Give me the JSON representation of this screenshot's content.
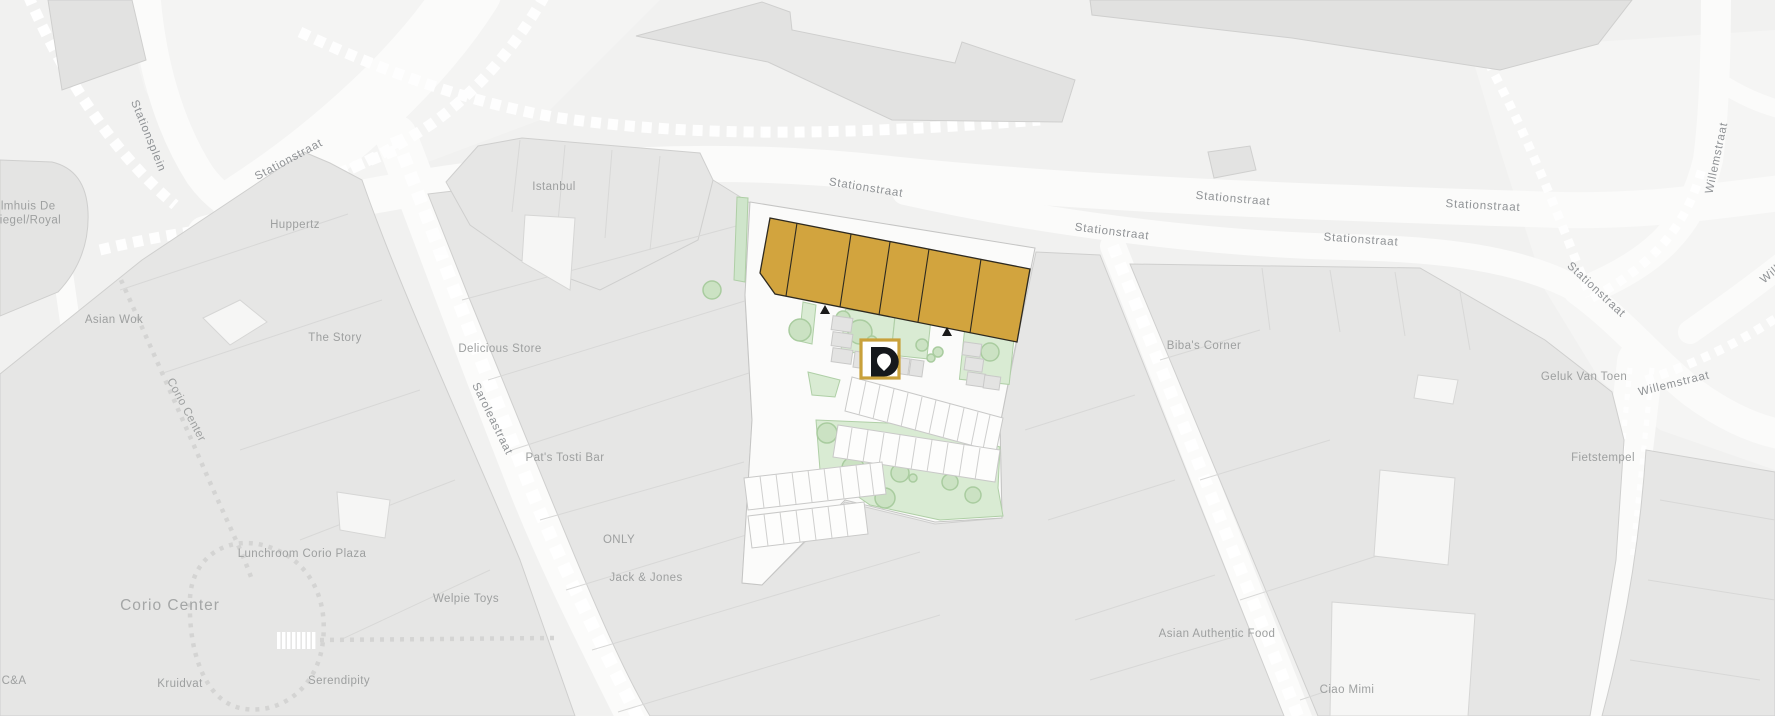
{
  "map": {
    "title": "Site location map - Stationstraat development",
    "labels": {
      "filmhuis": "Filmhuis De\nSpiegel/Royal",
      "stationsplein": "Stationsplein",
      "stationstraat_nw": "Stationstraat",
      "huppertz": "Huppertz",
      "istanbul": "Istanbul",
      "asian_wok": "Asian Wok",
      "the_story": "The Story",
      "delicious_store": "Delicious Store",
      "saroleastraat": "Saroleastraat",
      "corio_center_path": "Corio Center",
      "pats_tosti_bar": "Pat's Tosti Bar",
      "lunchroom_corio_plaza": "Lunchroom Corio Plaza",
      "corio_center": "Corio Center",
      "welpie_toys": "Welpie Toys",
      "only": "ONLY",
      "jack_jones": "Jack & Jones",
      "kruidvat": "Kruidvat",
      "serendipity": "Serendipity",
      "c_and_a": "C&A",
      "stationstraat_site": "Stationstraat",
      "stationstraat_s1": "Stationstraat",
      "stationstraat_n1": "Stationstraat",
      "stationstraat_s2": "Stationstraat",
      "stationstraat_n2": "Stationstraat",
      "stationstraat_diag": "Stationstraat",
      "willemstraat_n": "Willemstraat",
      "bibas_corner": "Biba's Corner",
      "geluk_van_toen": "Geluk Van Toen",
      "willemstraat_se": "Willemstraat",
      "willemstraat_edge": "Willemstraat",
      "fietstempel": "Fietstempel",
      "asian_authentic_food": "Asian Authentic Food",
      "ciao_mimi": "Ciao Mimi"
    },
    "marker": {
      "type": "property-location-marker",
      "glyph": "D-pin logo"
    },
    "site": {
      "highlighted_units": 6,
      "highlight_color": "#D2A43E"
    },
    "colors": {
      "background": "#F1F1F0",
      "building": "#E6E6E5",
      "road": "#FBFBFA",
      "green": "#D9EBD3",
      "highlight_gold": "#D2A43E",
      "marker_border": "#C9A13B",
      "marker_glyph": "#15181C",
      "label_gray": "#9A9C9E"
    }
  }
}
